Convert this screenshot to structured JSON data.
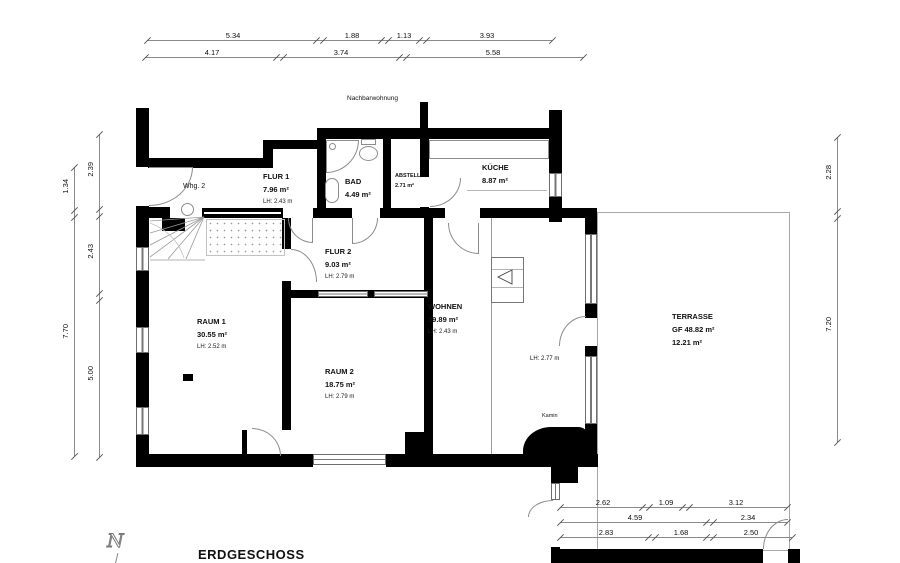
{
  "plan": {
    "title": "ERDGESCHOSS",
    "neighbor_label": "Nachbarwohnung",
    "compass_north": "N"
  },
  "rooms": {
    "whg2": {
      "name": "Whg. 2"
    },
    "flur1": {
      "name": "FLUR 1",
      "area": "7.96 m²",
      "height": "LH: 2.43 m"
    },
    "bad": {
      "name": "BAD",
      "area": "4.49 m²"
    },
    "abstell": {
      "name": "ABSTELL",
      "area": "2.71 m²"
    },
    "kueche": {
      "name": "KÜCHE",
      "area": "8.87 m²"
    },
    "flur2": {
      "name": "FLUR 2",
      "area": "9.03 m²",
      "height": "LH: 2.79 m"
    },
    "raum1": {
      "name": "RAUM 1",
      "area": "30.55 m²",
      "height": "LH: 2.52 m"
    },
    "raum2": {
      "name": "RAUM 2",
      "area": "18.75 m²",
      "height": "LH: 2.79 m"
    },
    "wohnen": {
      "name": "WOHNEN",
      "area": "39.89 m²",
      "height": "LH: 2.43 m",
      "height2": "LH: 2.77 m"
    },
    "terrasse": {
      "name": "TERRASSE",
      "area_gf": "GF 48.82 m²",
      "area": "12.21 m²"
    },
    "kamin": {
      "name": "Kamin"
    }
  },
  "dimensions": {
    "top_row1": [
      "5.34",
      "1.88",
      "1.13",
      "3.93"
    ],
    "top_row2": [
      "4.17",
      "3.74",
      "5.58"
    ],
    "left_outer": [
      "1.34",
      "7.70"
    ],
    "left_inner": [
      "2.39",
      "2.43",
      "5.00"
    ],
    "right": [
      "2.28",
      "7.20"
    ],
    "bottom_row1": [
      "2.62",
      "1.09",
      "3.12"
    ],
    "bottom_row2": [
      "4.59",
      "2.34"
    ],
    "bottom_row3": [
      "2.83",
      "1.68",
      "2.50"
    ]
  }
}
